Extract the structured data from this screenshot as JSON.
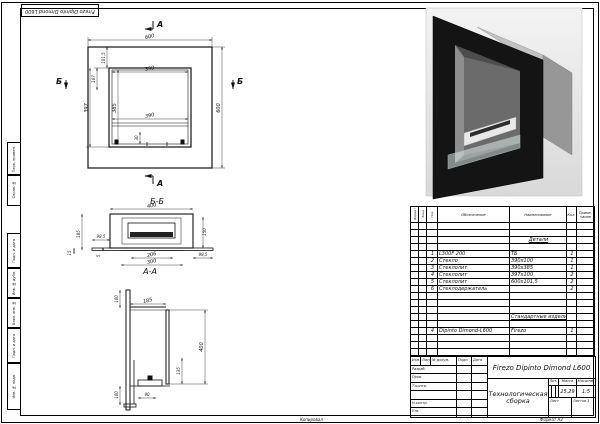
{
  "page": {
    "reversed_stamp": "Firezo Dipinto Dimond L600",
    "footer": {
      "copy": "Копировал",
      "format": "Формат А3"
    },
    "side_labels": [
      "Перв. примен.",
      "Справ. №",
      "Подп. и дата",
      "Инв. № дубл.",
      "Взам. инв. №",
      "Подп. и дата",
      "Инв. № подл."
    ]
  },
  "views": {
    "front": {
      "section_a": "А",
      "section_b": "Б",
      "dims": {
        "size": "600",
        "frame": "101,5",
        "inner_w": "390",
        "inner_h": "385",
        "opening_h": "397",
        "top_offset": "107",
        "glass_h": "30"
      }
    },
    "bb": {
      "label": "Б-Б",
      "burner": "FIREZO",
      "dims": {
        "width": "400",
        "depth": "185",
        "side_left": "98,5",
        "inner": "150",
        "burner_w": "206",
        "opening_w": "300",
        "side_right": "98,5",
        "lip": "15",
        "gap": "5"
      }
    },
    "aa": {
      "label": "А-А",
      "dims": {
        "top": "100",
        "depth": "185",
        "height": "400",
        "inner": "135",
        "bottom": "100",
        "base": "90"
      }
    }
  },
  "spec": {
    "headers": {
      "format": "Формат",
      "zone": "Зона",
      "pos": "Поз.",
      "designation": "Обозначение",
      "name": "Наименование",
      "qty": "Кол.",
      "note": "Приме- чание"
    },
    "rows": [
      {
        "f": "",
        "z": "",
        "p": "",
        "d": "",
        "n": "",
        "q": "",
        "note": ""
      },
      {
        "f": "",
        "z": "",
        "p": "",
        "d": "",
        "n": "",
        "q": "",
        "note": ""
      },
      {
        "f": "",
        "z": "",
        "p": "",
        "d": "",
        "n": "Детали",
        "q": "",
        "note": ""
      },
      {
        "f": "",
        "z": "",
        "p": "",
        "d": "",
        "n": "",
        "q": "",
        "note": ""
      },
      {
        "f": "",
        "z": "",
        "p": "1",
        "d": "L300F 200",
        "n": "ТБ",
        "q": "1",
        "note": ""
      },
      {
        "f": "",
        "z": "",
        "p": "2",
        "d": "Стекло",
        "n": "390х100",
        "q": "1",
        "note": ""
      },
      {
        "f": "",
        "z": "",
        "p": "3",
        "d": "Стеклолит",
        "n": "390х385",
        "q": "1",
        "note": ""
      },
      {
        "f": "",
        "z": "",
        "p": "4",
        "d": "Стеклолит",
        "n": "397х100",
        "q": "2",
        "note": ""
      },
      {
        "f": "",
        "z": "",
        "p": "5",
        "d": "Стеклолит",
        "n": "600х101,5",
        "q": "2",
        "note": ""
      },
      {
        "f": "",
        "z": "",
        "p": "6",
        "d": "Стеклодержатель",
        "n": "",
        "q": "2",
        "note": ""
      },
      {
        "f": "",
        "z": "",
        "p": "",
        "d": "",
        "n": "",
        "q": "",
        "note": ""
      },
      {
        "f": "",
        "z": "",
        "p": "",
        "d": "",
        "n": "",
        "q": "",
        "note": ""
      },
      {
        "f": "",
        "z": "",
        "p": "",
        "d": "",
        "n": "",
        "q": "",
        "note": ""
      },
      {
        "f": "",
        "z": "",
        "p": "",
        "d": "",
        "n": "Стандартные изделия",
        "q": "",
        "note": ""
      },
      {
        "f": "",
        "z": "",
        "p": "",
        "d": "",
        "n": "",
        "q": "",
        "note": ""
      },
      {
        "f": "",
        "z": "",
        "p": "4",
        "d": "Dipinto Dimond-L600",
        "n": "Firezo",
        "q": "1",
        "note": ""
      },
      {
        "f": "",
        "z": "",
        "p": "",
        "d": "",
        "n": "",
        "q": "",
        "note": ""
      },
      {
        "f": "",
        "z": "",
        "p": "",
        "d": "",
        "n": "",
        "q": "",
        "note": ""
      },
      {
        "f": "",
        "z": "",
        "p": "",
        "d": "",
        "n": "",
        "q": "",
        "note": ""
      }
    ]
  },
  "title_block": {
    "doc_name": "Firezo Dipinto Dimond L600",
    "doc_type": "Технологическая сборка",
    "labels": {
      "lit": "Лит.",
      "mass": "Масса",
      "scale": "Масштаб",
      "sheet": "Лист",
      "sheets": "Листов"
    },
    "values": {
      "mass": "25,29",
      "scale": "1:5",
      "sheets": "1"
    },
    "sig_headers": [
      "Изм.",
      "Лист",
      "№ докум.",
      "Подп.",
      "Дата"
    ],
    "sig_rows": [
      "Разраб.",
      "Пров.",
      "Т.контр.",
      "Н.контр.",
      "Утв."
    ]
  }
}
